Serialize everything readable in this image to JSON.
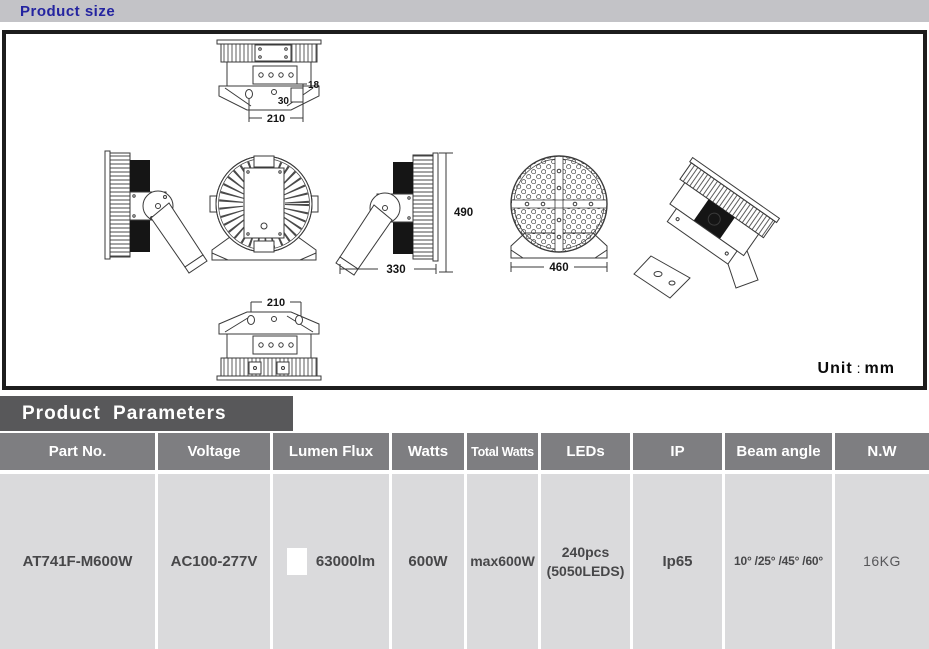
{
  "header": {
    "title": "Product size"
  },
  "drawing": {
    "unit_label": "Unit",
    "unit_separator": ":",
    "unit_value": "mm",
    "dims": {
      "top_hole": "18",
      "top_bracket": "30",
      "top_mount_width": "210",
      "overall_height": "490",
      "side_depth": "330",
      "face_diameter": "460",
      "bottom_mount_width": "210"
    }
  },
  "parameters": {
    "section_title": "Product Parameters",
    "columns": [
      "Part No.",
      "Voltage",
      "Lumen Flux",
      "Watts",
      "Total Watts",
      "LEDs",
      "IP",
      "Beam angle",
      "N.W"
    ],
    "row": {
      "part_no": "AT741F-M600W",
      "voltage": "AC100-277V",
      "lumen_flux": "63000lm",
      "watts": "600W",
      "total_watts": "max600W",
      "leds_line1": "240pcs",
      "leds_line2": "(5050LEDS)",
      "ip": "Ip65",
      "beam_angle": "10° /25° /45° /60°",
      "net_weight": "16KG"
    }
  },
  "colors": {
    "title_bar_bg": "#c3c3c7",
    "title_text": "#2424a0",
    "section_header_bg": "#58585a",
    "table_header_bg": "#7e7e81",
    "table_row_bg": "#dadadc",
    "drawing_border": "#1d1d1d"
  }
}
